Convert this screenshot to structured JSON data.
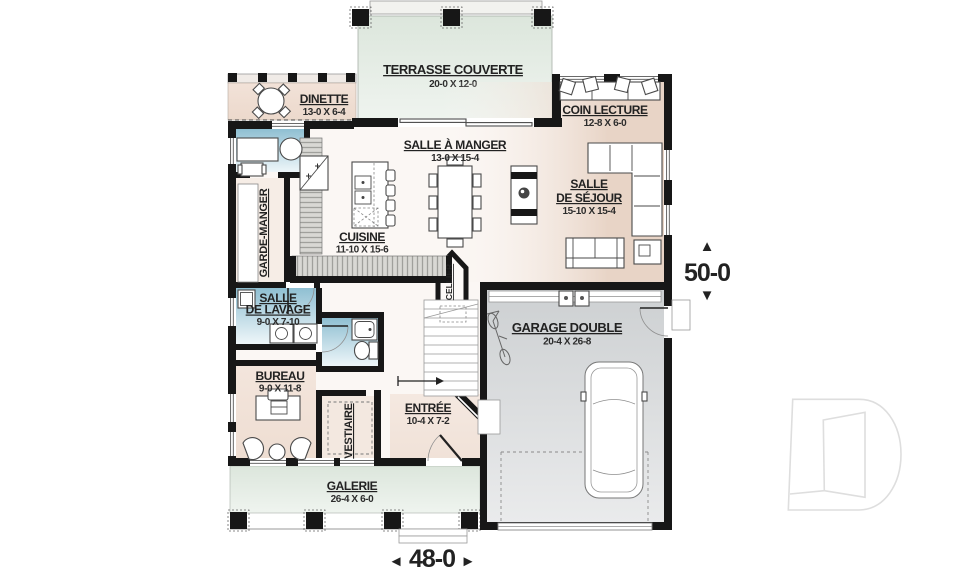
{
  "rooms": {
    "terrasse": {
      "name": "TERRASSE COUVERTE",
      "dims": "20-0 X 12-0"
    },
    "dinette": {
      "name": "DINETTE",
      "dims": "13-0 X 6-4"
    },
    "coin_lecture": {
      "name": "COIN LECTURE",
      "dims": "12-8 X 6-0"
    },
    "salle_a_manger": {
      "name": "SALLE À MANGER",
      "dims": "13-0 X 15-4"
    },
    "salle_de_sejour": {
      "line1": "SALLE",
      "line2": "DE SÉJOUR",
      "dims": "15-10 X 15-4"
    },
    "cuisine": {
      "name": "CUISINE",
      "dims": "11-10 X 15-6"
    },
    "garde_manger": {
      "name": "GARDE-MANGER"
    },
    "salle_de_lavage": {
      "line1": "SALLE",
      "line2": "DE LAVAGE",
      "dims": "9-0 X 7-10"
    },
    "bureau": {
      "name": "BUREAU",
      "dims": "9-0 X 11-8"
    },
    "vestiaire": {
      "name": "VESTIAIRE"
    },
    "entree": {
      "name": "ENTRÉE",
      "dims": "10-4 X 7-2"
    },
    "cellier": {
      "name": "CELLIER"
    },
    "garage": {
      "name": "GARAGE DOUBLE",
      "dims": "20-4 X 26-8"
    },
    "galerie": {
      "name": "GALERIE",
      "dims": "26-4 X 6-0"
    }
  },
  "dimensions": {
    "overall_width": "48-0",
    "overall_depth": "50-0"
  },
  "icons": {
    "arrow_up": "▲",
    "arrow_down": "▼",
    "arrow_left": "◄",
    "arrow_right": "►"
  },
  "colors": {
    "wall": "#171717",
    "interior_warm": "#e8d4c6",
    "porch_green": "#dfe8df",
    "wet_room_blue": "#8fbfd2",
    "garage_gray": "#d3d6d8",
    "text": "#222222",
    "watermark": "#dedede"
  }
}
